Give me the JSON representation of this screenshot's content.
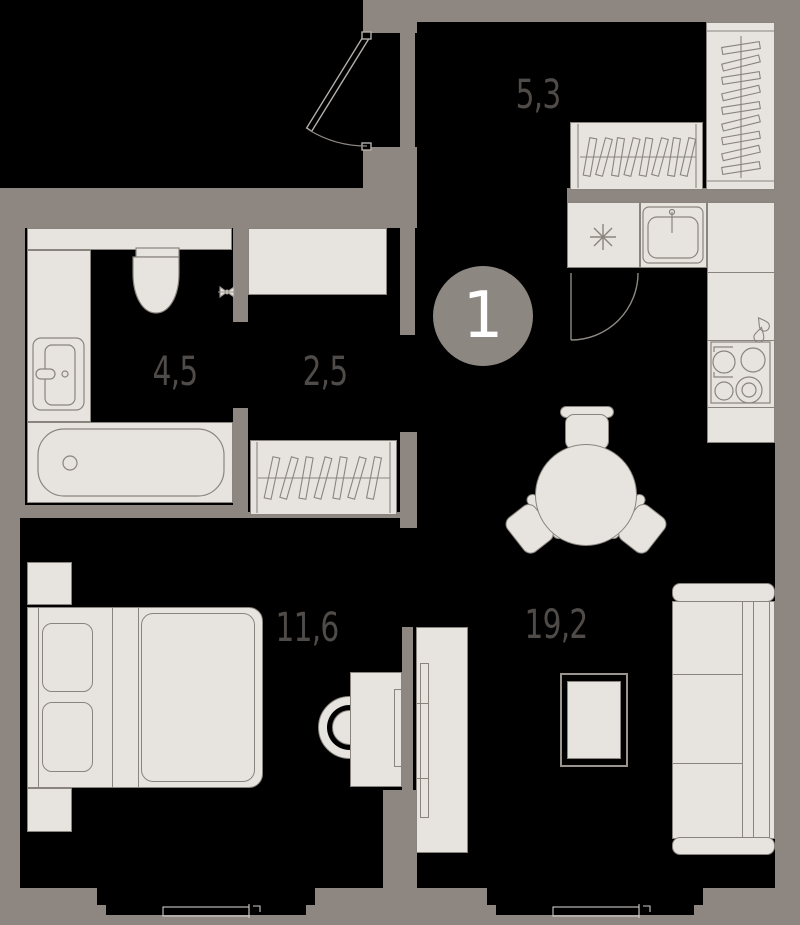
{
  "plan": {
    "unit_number": "1",
    "rooms": [
      {
        "name": "hall",
        "area_label": "5,3"
      },
      {
        "name": "bathroom",
        "area_label": "4,5"
      },
      {
        "name": "corridor",
        "area_label": "2,5"
      },
      {
        "name": "bedroom",
        "area_label": "11,6"
      },
      {
        "name": "living-kitchen",
        "area_label": "19,2"
      }
    ],
    "fixtures": [
      "entry-door-icon",
      "kitchen-door-icon",
      "wardrobe-icon",
      "closet-icon",
      "toilet-icon",
      "bathroom-sink-icon",
      "shutoff-valve-icon",
      "bathtub-icon",
      "kitchen-sink-icon",
      "stove-symbol-icon",
      "hob-icon",
      "dining-table-icon",
      "chair-icon",
      "sofa-icon",
      "ottoman-icon",
      "tv-stand-icon",
      "desk-icon",
      "desk-chair-icon",
      "bed-icon",
      "nightstand-icon",
      "window-icon"
    ],
    "colors": {
      "background": "#000000",
      "walls": "#8e8781",
      "fixtures": "#e7e4e0",
      "outline": "#8a847e",
      "label_text": "#4f4b48",
      "badge": "#8d8781",
      "badge_text": "#ffffff"
    }
  }
}
